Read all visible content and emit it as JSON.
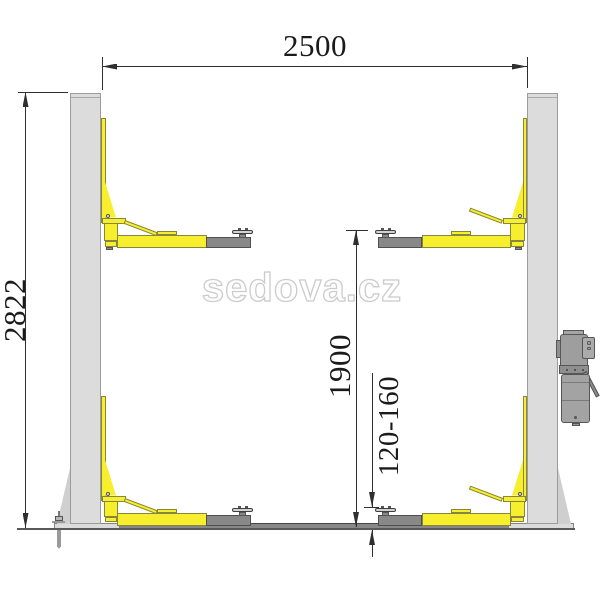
{
  "diagram": {
    "title": "two-post car lift dimensional drawing",
    "watermark": "sedova.cz",
    "dimensions": {
      "overall_width": "2500",
      "overall_height": "2822",
      "max_lift_height": "1900",
      "min_pad_height": "120-160"
    }
  },
  "colors": {
    "accent_yellow": "#f7ee2e",
    "post_gray": "#dcdcdc",
    "steel_gray": "#888888",
    "pad_gray": "#d2d2d2",
    "motor_gray": "#9e9e9e",
    "dim_line": "#2f2f2f",
    "text_color": "#1b1b1b",
    "watermark_stroke": "#cccccc"
  }
}
